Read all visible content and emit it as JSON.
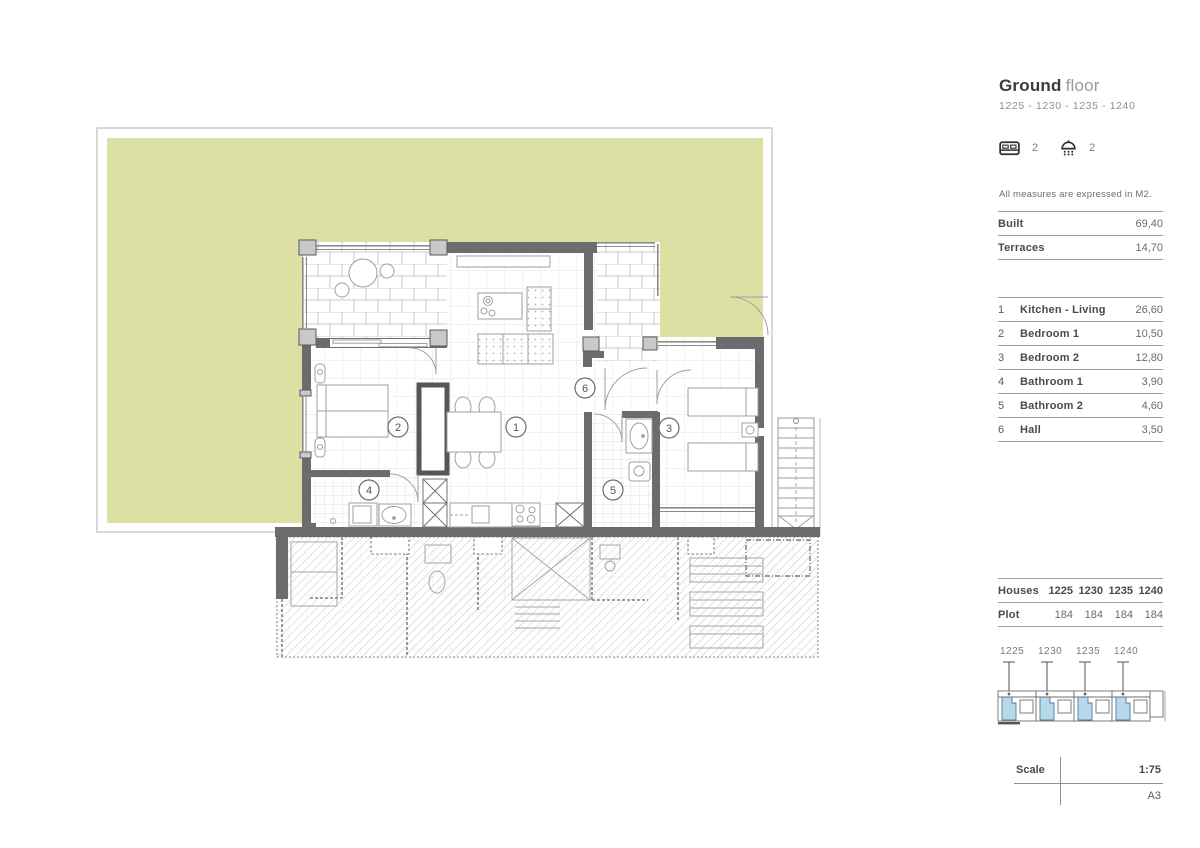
{
  "header": {
    "title_main": "Ground",
    "title_sub": "floor",
    "subtitle": "1225 - 1230 - 1235 - 1240"
  },
  "amenities": {
    "bed_icon": "bed-icon",
    "shower_icon": "shower-icon",
    "bedrooms_count": "2",
    "bathrooms_count": "2"
  },
  "note": "All measures are expressed in M2.",
  "stats": [
    {
      "label": "Built",
      "value": "69,40"
    },
    {
      "label": "Terraces",
      "value": "14,70"
    }
  ],
  "rooms": [
    {
      "n": "1",
      "name": "Kitchen - Living",
      "area": "26,60"
    },
    {
      "n": "2",
      "name": "Bedroom 1",
      "area": "10,50"
    },
    {
      "n": "3",
      "name": "Bedroom 2",
      "area": "12,80"
    },
    {
      "n": "4",
      "name": "Bathroom 1",
      "area": "3,90"
    },
    {
      "n": "5",
      "name": "Bathroom 2",
      "area": "4,60"
    },
    {
      "n": "6",
      "name": "Hall",
      "area": "3,50"
    }
  ],
  "houses_table": {
    "row1_label": "Houses",
    "row2_label": "Plot",
    "columns": [
      "1225",
      "1230",
      "1235",
      "1240"
    ],
    "plots": [
      "184",
      "184",
      "184",
      "184"
    ]
  },
  "site": {
    "unit_labels": [
      "1225",
      "1230",
      "1235",
      "1240"
    ],
    "highlight_color": "#b7d9ea"
  },
  "plan": {
    "terrace_color": "#dce0a2",
    "wall_color": "#6b6c6e",
    "room_labels": [
      {
        "n": "1"
      },
      {
        "n": "2"
      },
      {
        "n": "3"
      },
      {
        "n": "4"
      },
      {
        "n": "5"
      },
      {
        "n": "6"
      }
    ]
  },
  "scale": {
    "label": "Scale",
    "value": "1:75",
    "paper": "A3"
  }
}
